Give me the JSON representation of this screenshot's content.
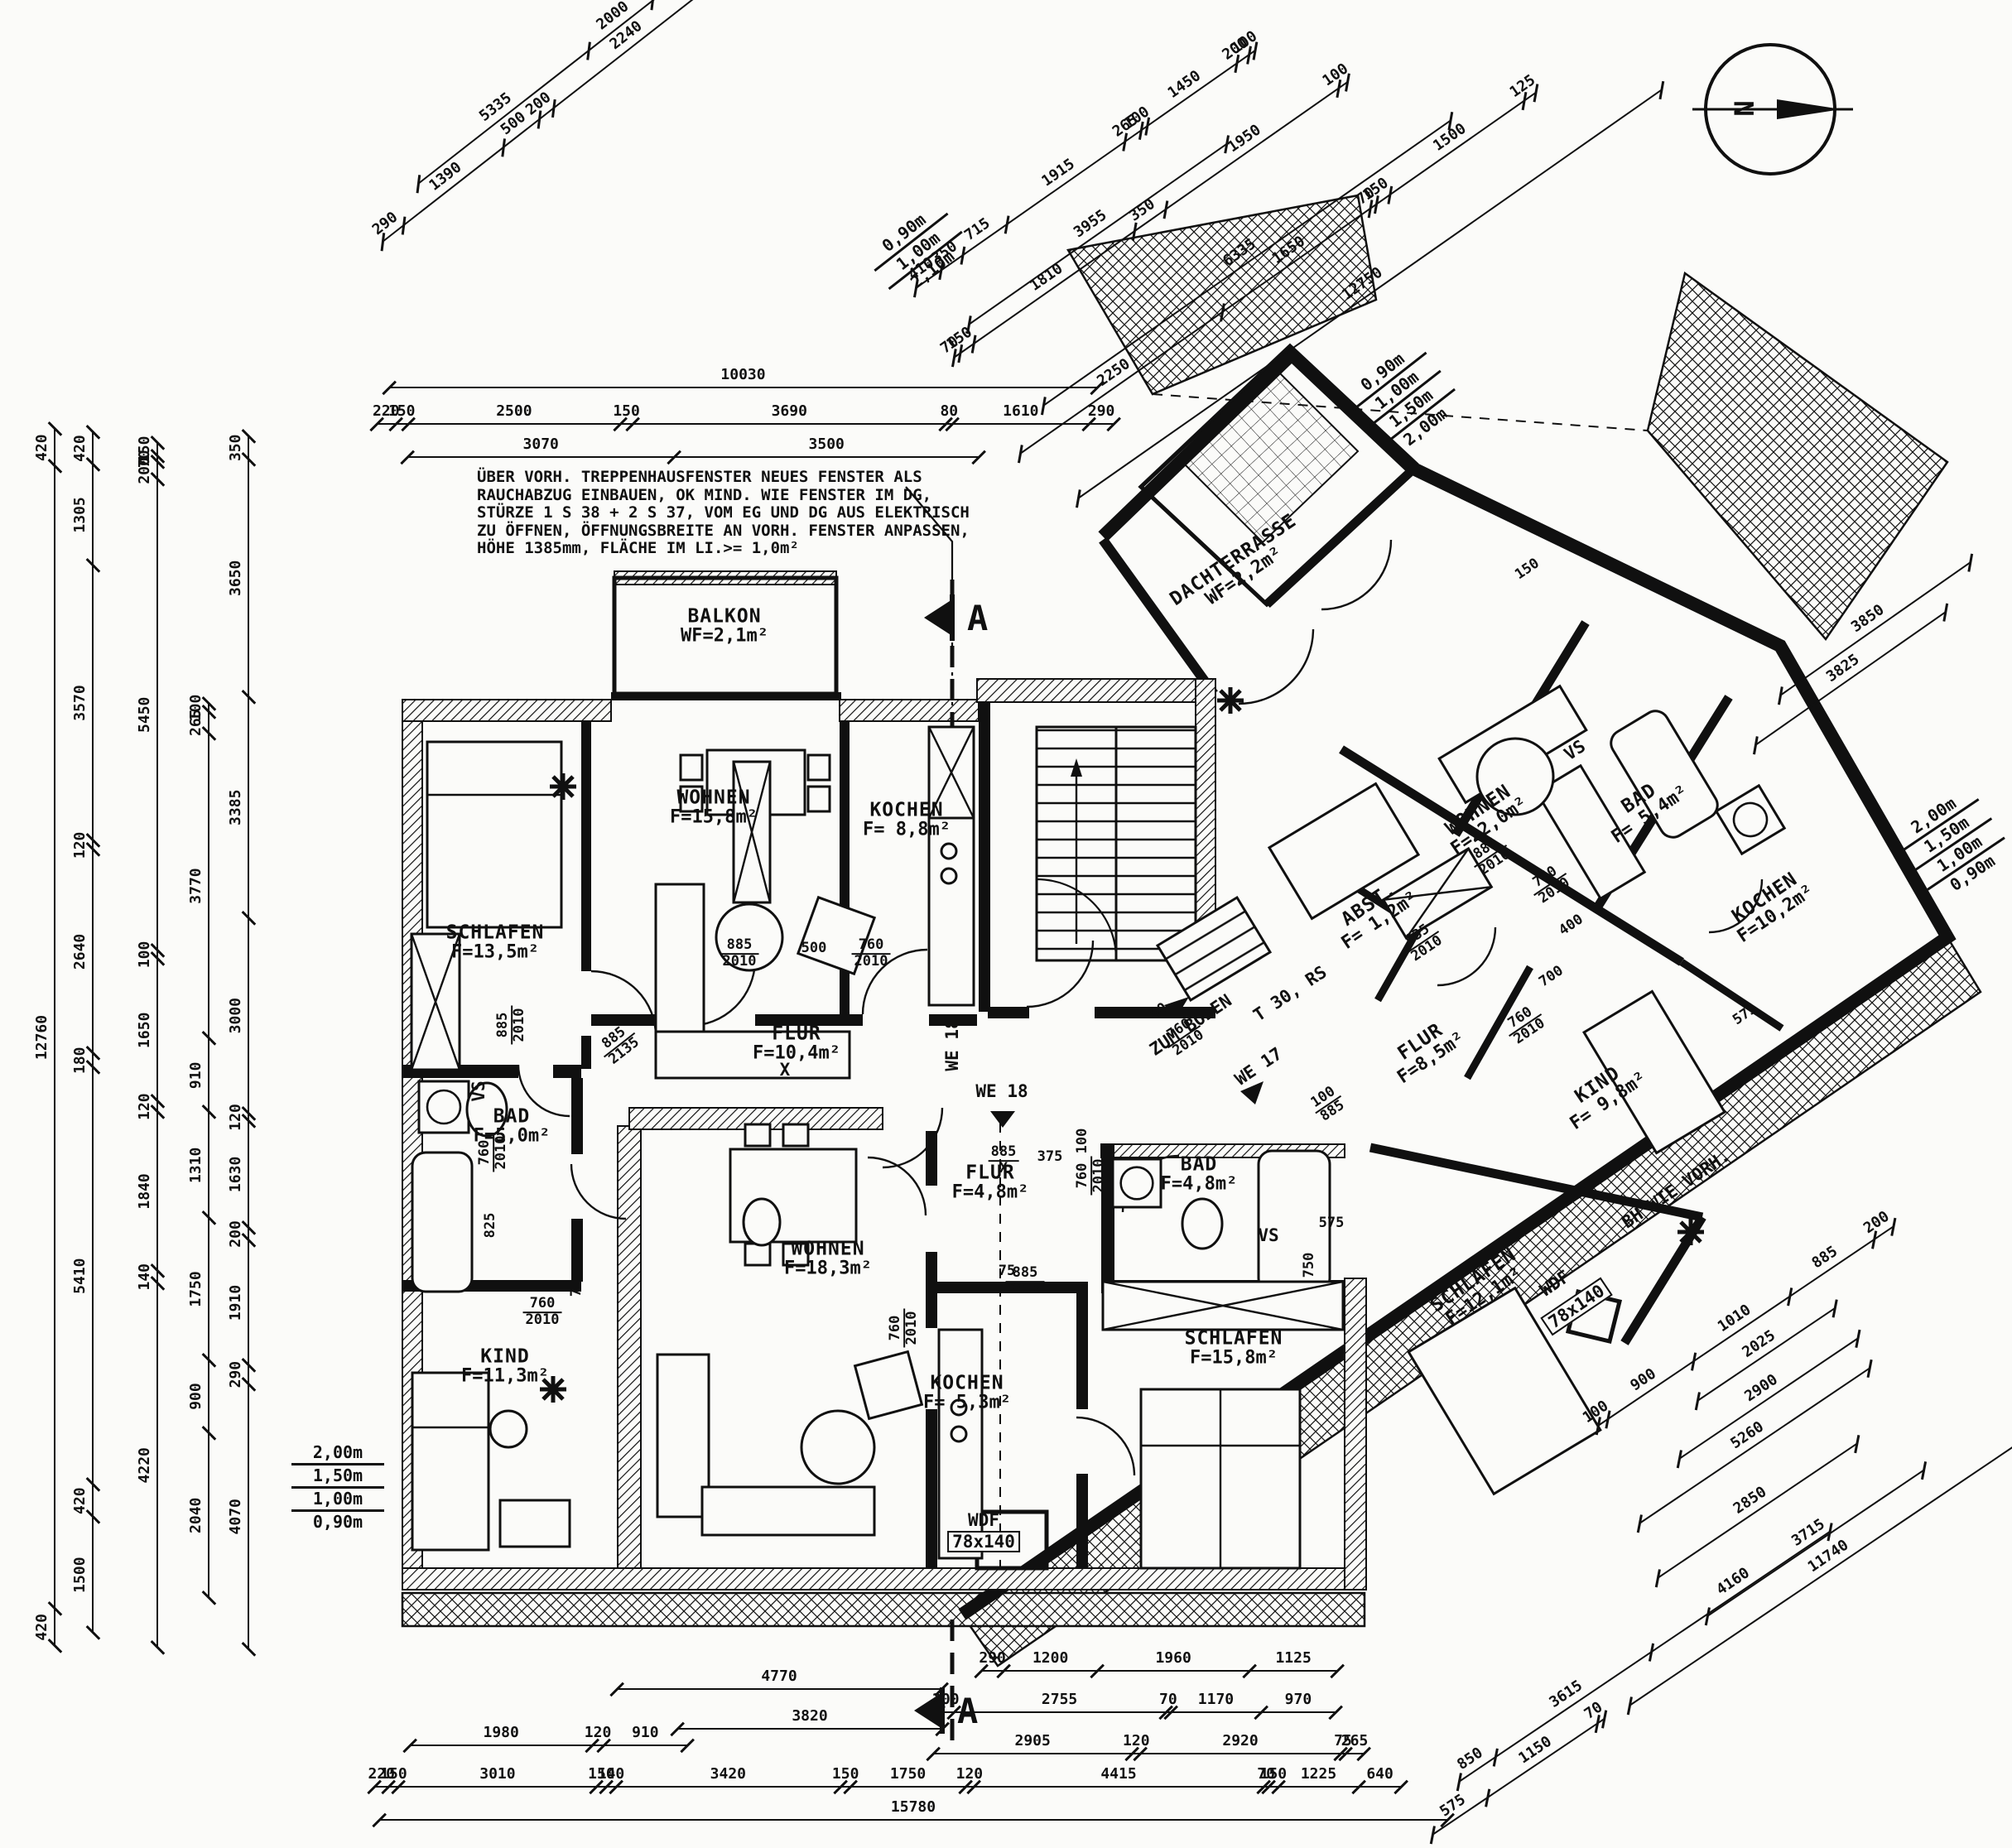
{
  "sheet": {
    "background": "#fbfbf9",
    "ink": "#101010"
  },
  "north_arrow": {
    "label": "N"
  },
  "section_markers": {
    "top": "A",
    "bottom": "A"
  },
  "note": {
    "lines": [
      "ÜBER VORH. TREPPENHAUSFENSTER NEUES FENSTER ALS",
      "RAUCHABZUG EINBAUEN, OK MIND. WIE FENSTER IM DG,",
      "STÜRZE 1 S 38 + 2 S 37, VOM EG UND DG AUS ELEKTRISCH",
      "ZU ÖFFNEN, ÖFFNUNGSBREITE AN VORH. FENSTER ANPASSEN,",
      "HÖHE 1385mm, FLÄCHE IM LI.>= 1,0m²"
    ]
  },
  "height_stacks": {
    "left": [
      "2,00m",
      "1,50m",
      "1,00m",
      "0,90m"
    ],
    "top_right": [
      "0,90m",
      "1,00m",
      "1,50m",
      "2,00m"
    ],
    "terrace": [
      "0,90m",
      "1,00m",
      "2,10m"
    ],
    "outer_right": [
      "2,00m",
      "1,50m",
      "1,00m",
      "0,90m"
    ]
  },
  "rooms": [
    {
      "id": "balkon",
      "name": "BALKON",
      "area": "WF=2,1m²"
    },
    {
      "id": "schlafen1",
      "name": "SCHLAFEN",
      "area": "F=13,5m²"
    },
    {
      "id": "wohnen1",
      "name": "WOHNEN",
      "area": "F=15,8m²"
    },
    {
      "id": "kochen1",
      "name": "KOCHEN",
      "area": "F= 8,8m²"
    },
    {
      "id": "flur1",
      "name": "FLUR",
      "area": "F=10,4m²"
    },
    {
      "id": "bad1",
      "name": "BAD",
      "area": "F=5,0m²"
    },
    {
      "id": "kind1",
      "name": "KIND",
      "area": "F=11,3m²"
    },
    {
      "id": "wohnen2",
      "name": "WOHNEN",
      "area": "F=18,3m²"
    },
    {
      "id": "flur2",
      "name": "FLUR",
      "area": "F=4,8m²"
    },
    {
      "id": "kochen2",
      "name": "KOCHEN",
      "area": "F= 5,3m²"
    },
    {
      "id": "bad2",
      "name": "BAD",
      "area": "F=4,8m²"
    },
    {
      "id": "schlafen2",
      "name": "SCHLAFEN",
      "area": "F=15,8m²"
    },
    {
      "id": "dachterrasse",
      "name": "DACHTERRASSE",
      "area": "WF=2,2m²"
    },
    {
      "id": "wohnen3",
      "name": "WOHNEN",
      "area": "F=22,0m²"
    },
    {
      "id": "abst",
      "name": "ABST.",
      "area": "F= 1,2m²"
    },
    {
      "id": "bad3",
      "name": "BAD",
      "area": "F= 5,4m²"
    },
    {
      "id": "kochen3",
      "name": "KOCHEN",
      "area": "F=10,2m²"
    },
    {
      "id": "flur3",
      "name": "FLUR",
      "area": "F=8,5m²"
    },
    {
      "id": "kind2",
      "name": "KIND",
      "area": "F= 9,8m²"
    },
    {
      "id": "schlafen3",
      "name": "SCHLAFEN",
      "area": "F=12,1m²"
    }
  ],
  "labels": [
    {
      "id": "we18",
      "text": "WE 18"
    },
    {
      "id": "we18v",
      "text": "WE 18"
    },
    {
      "id": "we17",
      "text": "WE 17"
    },
    {
      "id": "zum_boden",
      "text": "ZUM BODEN"
    },
    {
      "id": "t30rs",
      "text": "T 30, RS"
    },
    {
      "id": "wdf1",
      "text": "WDF"
    },
    {
      "id": "wdf1_size",
      "text": "78x140"
    },
    {
      "id": "wdf2",
      "text": "WDF"
    },
    {
      "id": "wdf2_size",
      "text": "78x140"
    },
    {
      "id": "bh_wie_vorh",
      "text": "BH WIE VORH."
    },
    {
      "id": "x_mark1",
      "text": "X"
    },
    {
      "id": "vs1",
      "text": "VS"
    },
    {
      "id": "vs2",
      "text": "VS"
    },
    {
      "id": "vs3",
      "text": "VS"
    }
  ],
  "door_dims": [
    {
      "id": "f1",
      "top": "885",
      "bot": "2010"
    },
    {
      "id": "f2",
      "top": "500",
      "bot": ""
    },
    {
      "id": "f3",
      "top": "760",
      "bot": "2010"
    },
    {
      "id": "f4",
      "top": "885",
      "bot": "2135"
    },
    {
      "id": "f5",
      "top": "885",
      "bot": "2010"
    },
    {
      "id": "f6",
      "top": "760",
      "bot": "2010"
    },
    {
      "id": "f7",
      "top": "825",
      "bot": ""
    },
    {
      "id": "f8",
      "top": "760",
      "bot": "2010"
    },
    {
      "id": "f9",
      "top": "75",
      "bot": ""
    },
    {
      "id": "f10",
      "top": "885",
      "bot": "X"
    },
    {
      "id": "f11",
      "top": "375",
      "bot": ""
    },
    {
      "id": "f12",
      "top": "100",
      "bot": ""
    },
    {
      "id": "f13",
      "top": "760",
      "bot": "2010"
    },
    {
      "id": "f14",
      "top": "885",
      "bot": "2010"
    },
    {
      "id": "f15",
      "top": "75",
      "bot": ""
    },
    {
      "id": "f16",
      "top": "760",
      "bot": "2010"
    },
    {
      "id": "f17",
      "top": "575",
      "bot": ""
    },
    {
      "id": "f18",
      "top": "750",
      "bot": ""
    },
    {
      "id": "f20",
      "top": "885",
      "bot": "2010"
    },
    {
      "id": "f22",
      "top": "760",
      "bot": "2010"
    },
    {
      "id": "f23",
      "top": "635",
      "bot": "2010"
    },
    {
      "id": "f24",
      "top": "700",
      "bot": ""
    },
    {
      "id": "f25",
      "top": "760",
      "bot": "2010"
    },
    {
      "id": "f26",
      "top": "400",
      "bot": ""
    },
    {
      "id": "f27",
      "top": "100",
      "bot": "885"
    },
    {
      "id": "f28",
      "top": "80",
      "bot": ""
    },
    {
      "id": "f29",
      "top": "760",
      "bot": "2010"
    },
    {
      "id": "f31",
      "top": "575",
      "bot": ""
    },
    {
      "id": "f32",
      "top": "150",
      "bot": ""
    }
  ],
  "dim_chains": {
    "tc1": [
      "10030"
    ],
    "tc2": [
      "220",
      "150",
      "2500",
      "150",
      "3690",
      "80",
      "1610",
      "290"
    ],
    "tc3": [
      "3070",
      "3500"
    ],
    "tlc1": [
      "290",
      "1390",
      "500",
      "200",
      "2240",
      "540",
      "290"
    ],
    "tlc2": [
      "5335",
      "2000",
      "3000",
      "1100"
    ],
    "trc1": [
      "410",
      "350",
      "715",
      "1915",
      "265",
      "100",
      "1450",
      "200",
      "100"
    ],
    "trc2": [
      "70",
      "150",
      "1810",
      "350",
      "1950",
      "100"
    ],
    "trc3": [
      "2250",
      "1650",
      "70",
      "150",
      "1500",
      "125"
    ],
    "trc4": [
      "3955"
    ],
    "trc5": [
      "6335"
    ],
    "trc6": [
      "12750"
    ],
    "rrc1": [
      "3850"
    ],
    "rrc2": [
      "3825"
    ],
    "brc1": [
      "100",
      "900",
      "1010",
      "885",
      "200"
    ],
    "brc2": [
      "2025"
    ],
    "brc3": [
      "2900"
    ],
    "brc4": [
      "5260"
    ],
    "brc5": [
      "2850"
    ],
    "brc6": [
      "3715"
    ],
    "brc7": [
      "11740"
    ],
    "brc8": [
      "850",
      "3615",
      "4160"
    ],
    "brc9": [
      "575",
      "1150",
      "70"
    ],
    "bc1": [
      "290",
      "1200",
      "1960",
      "1125"
    ],
    "bc2": [
      "4770"
    ],
    "bc3": [
      "200",
      "2755",
      "70",
      "1170",
      "970"
    ],
    "bc4": [
      "3820"
    ],
    "bc5": [
      "1980",
      "120",
      "910"
    ],
    "bc6": [
      "2905",
      "120",
      "2920",
      "75",
      "265"
    ],
    "bc7": [
      "220",
      "150",
      "3010",
      "150",
      "140",
      "3420",
      "150",
      "1750",
      "120",
      "4415",
      "70",
      "150",
      "1225",
      "640"
    ],
    "bc8": [
      "15780"
    ],
    "vc1": [
      "420",
      "12760",
      "420"
    ],
    "vc2": [
      "1500",
      "420",
      "5410",
      "180",
      "2640",
      "120",
      "3570",
      "1305",
      "420"
    ],
    "vc3": [
      "4220",
      "140",
      "1840",
      "120",
      "1650",
      "100",
      "5450",
      "200",
      "70",
      "150"
    ],
    "vc4": [
      "4070",
      "290",
      "1910",
      "200",
      "1630",
      "120",
      "3000",
      "3385",
      "3650",
      "350"
    ],
    "vc5": [
      "2040",
      "900",
      "1750",
      "1310",
      "910",
      "3770",
      "265",
      "100"
    ]
  }
}
